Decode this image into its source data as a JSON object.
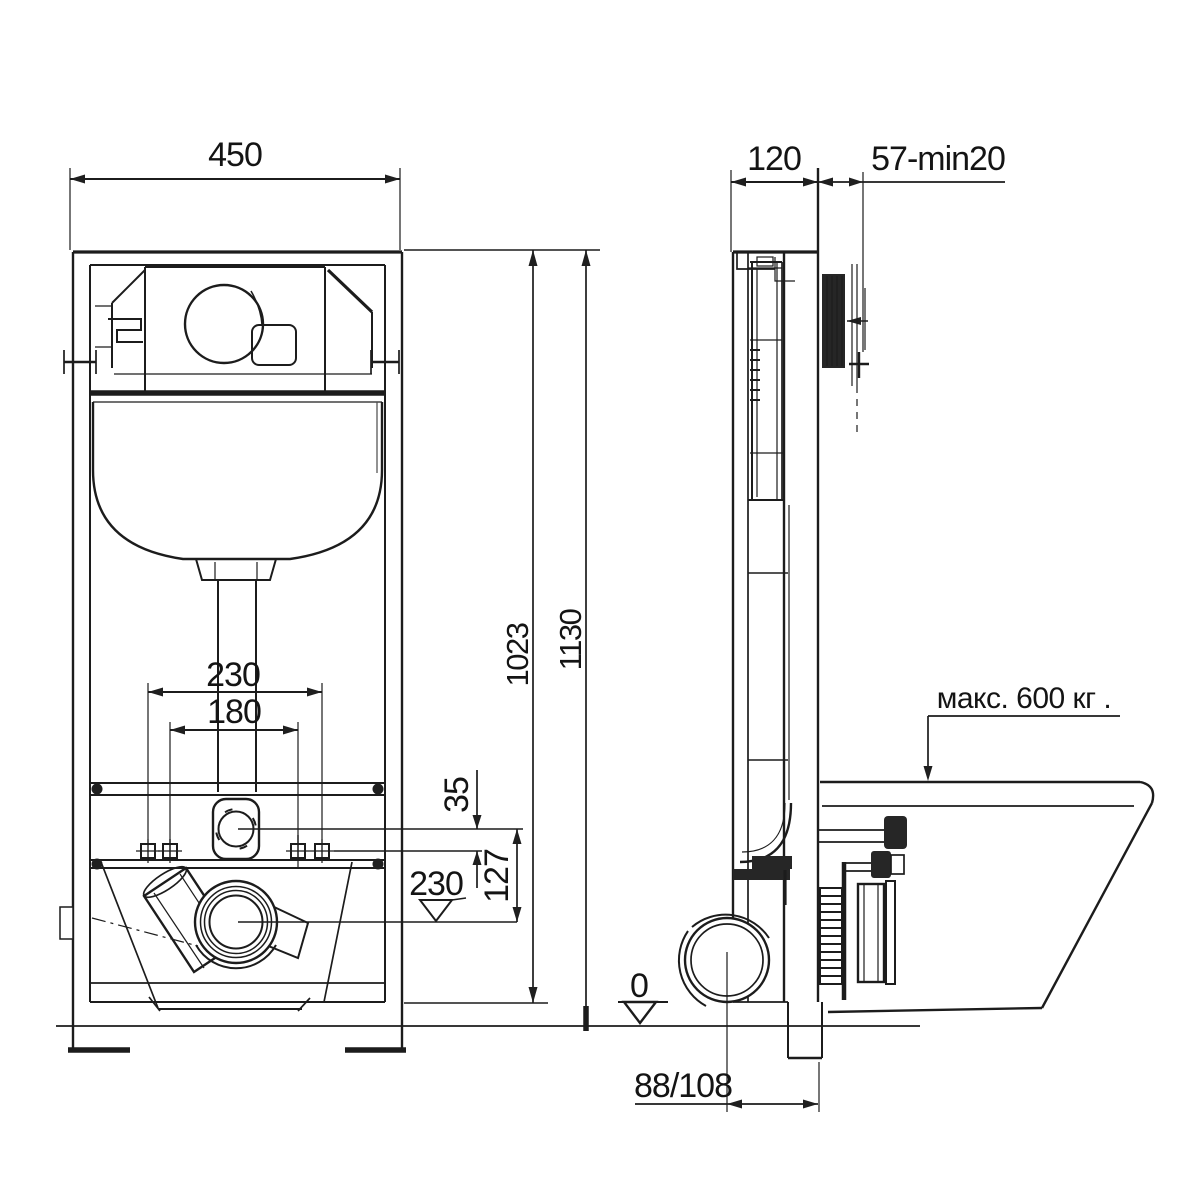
{
  "front_view": {
    "dim_width": "450",
    "dim_bolt_spacing_outer": "230",
    "dim_bolt_spacing_inner": "180",
    "dim_supply_offset": "35",
    "dim_supply_to_outlet": "127",
    "dim_outlet_level": "230",
    "dim_frame_height": "1023",
    "dim_total_height": "1130"
  },
  "side_view": {
    "dim_depth": "120",
    "dim_finish_range": "57-min20",
    "max_load_label": "макс. 600 кг .",
    "floor_level_label": "0",
    "dim_outlet_offset": "88/108"
  }
}
